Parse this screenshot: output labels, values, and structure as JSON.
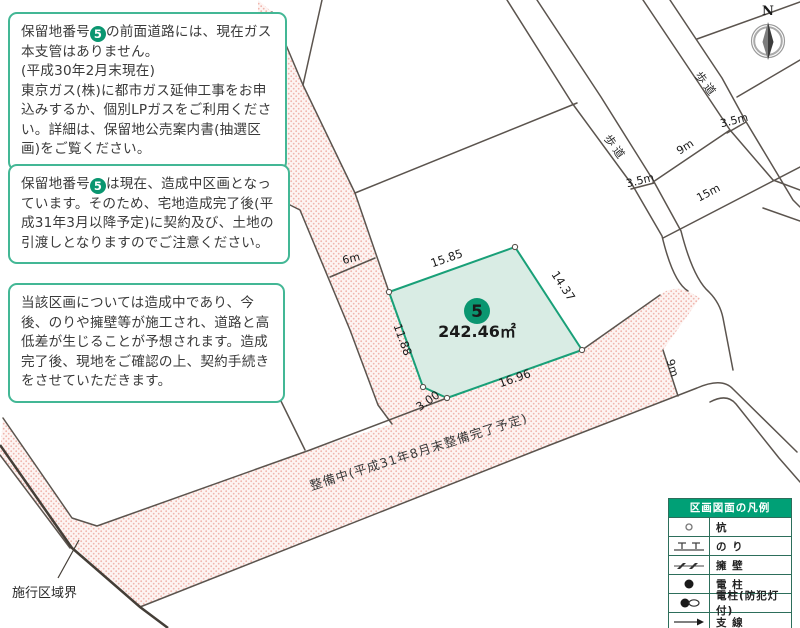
{
  "notes": [
    {
      "pre": "保留地番号",
      "num": "5",
      "body": "の前面道路には、現在ガス本支管はありません。\n(平成30年2月末現在)\n東京ガス(株)に都市ガス延伸工事をお申込みするか、個別LPガスをご利用ください。詳細は、保留地公売案内書(抽選区画)をご覧ください。"
    },
    {
      "pre": "保留地番号",
      "num": "5",
      "body": "は現在、造成中区画となっています。そのため、宅地造成完了後(平成31年3月以降予定)に契約及び、土地の引渡しとなりますのでご注意ください。"
    },
    {
      "pre": "",
      "num": "",
      "body": "当該区画については造成中であり、今後、のりや擁壁等が施工され、道路と高低差が生じることが予想されます。造成完了後、現地をご確認の上、契約手続きをさせていただきます。"
    }
  ],
  "plot": {
    "number": "5",
    "area": "242.46㎡",
    "dimensions": {
      "top": "15.85",
      "right": "14.37",
      "bottom": "16.96",
      "left": "11.88",
      "corner": "3.00"
    }
  },
  "roads": {
    "width_6m": "6m",
    "width_9m_east": "9m",
    "width_9m_street": "9m",
    "width_15m": "15m",
    "sidewalk_width_left": "3.5m",
    "sidewalk_width_right": "3.5m",
    "sidewalk_left": "歩道",
    "sidewalk_right": "歩道",
    "status_note": "整備中(平成31年8月末整備完了予定)"
  },
  "boundary_label": "施行区域界",
  "compass": {
    "label": "N"
  },
  "legend": {
    "title": "区画図面の凡例",
    "rows": [
      {
        "symbol": "stake-circle",
        "label": "杭"
      },
      {
        "symbol": "slope-nori",
        "label": "の り"
      },
      {
        "symbol": "retaining-wall",
        "label": "擁 壁"
      },
      {
        "symbol": "utility-pole",
        "label": "電 柱"
      },
      {
        "symbol": "utility-pole-crime-light",
        "label": "電柱(防犯灯付)"
      },
      {
        "symbol": "guy-wire",
        "label": "支 線"
      }
    ]
  },
  "colors": {
    "accent_green": "#00a076",
    "box_border": "#43b795",
    "plot_fill": "#d9ece4",
    "plot_stroke": "#19a078",
    "road_dot": "#f0b5ad",
    "map_line": "#5b544e"
  }
}
